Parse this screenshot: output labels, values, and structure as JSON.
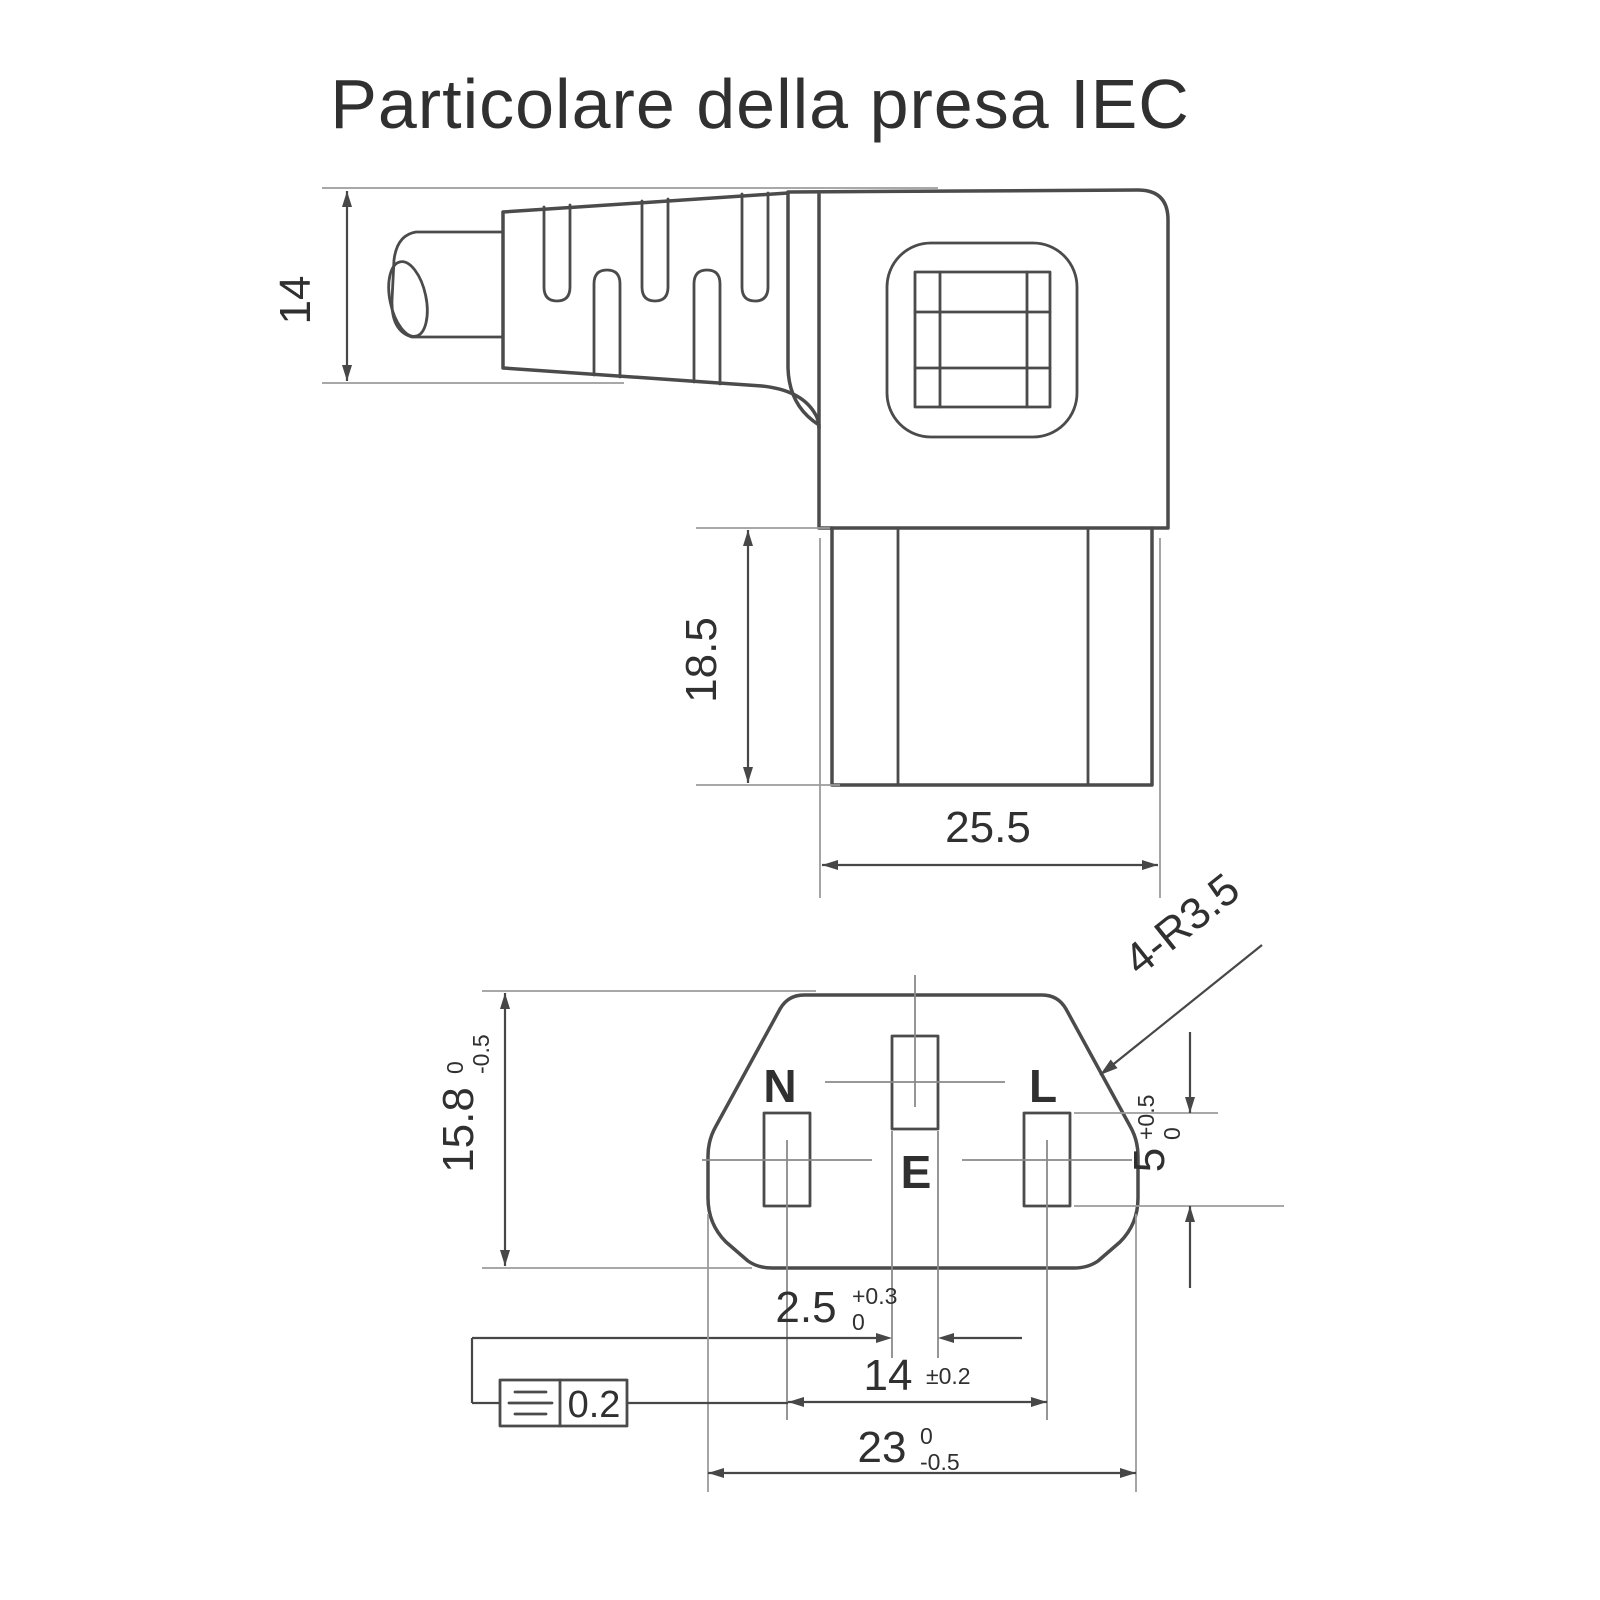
{
  "title": "Particolare della presa IEC",
  "colors": {
    "background": "#ffffff",
    "outline": "#4b4b4b",
    "extension_lines": "#9b9b9b",
    "dimension_lines": "#474747",
    "text": "#303030"
  },
  "side_view": {
    "dim_cable_height": {
      "value": "14"
    },
    "dim_shroud_height": {
      "value": "18.5"
    },
    "dim_shroud_width": {
      "value": "25.5"
    }
  },
  "face_view": {
    "pin_neutral": "N",
    "pin_earth": "E",
    "pin_line": "L",
    "dim_face_height": {
      "value": "15.8",
      "sup": "0",
      "sub": "-0.5"
    },
    "dim_slot_height": {
      "value": "5",
      "sup": "+0.5",
      "sub": "0"
    },
    "dim_slot_width": {
      "value": "2.5",
      "sup": "+0.3",
      "sub": "0"
    },
    "dim_pin_spacing": {
      "value": "14",
      "tol": "±0.2"
    },
    "dim_face_width": {
      "value": "23",
      "sup": "0",
      "sub": "-0.5"
    },
    "label_corner_radius": "4-R3.5",
    "tolerance_frame": {
      "value": "0.2",
      "symbol": "symmetry"
    }
  }
}
